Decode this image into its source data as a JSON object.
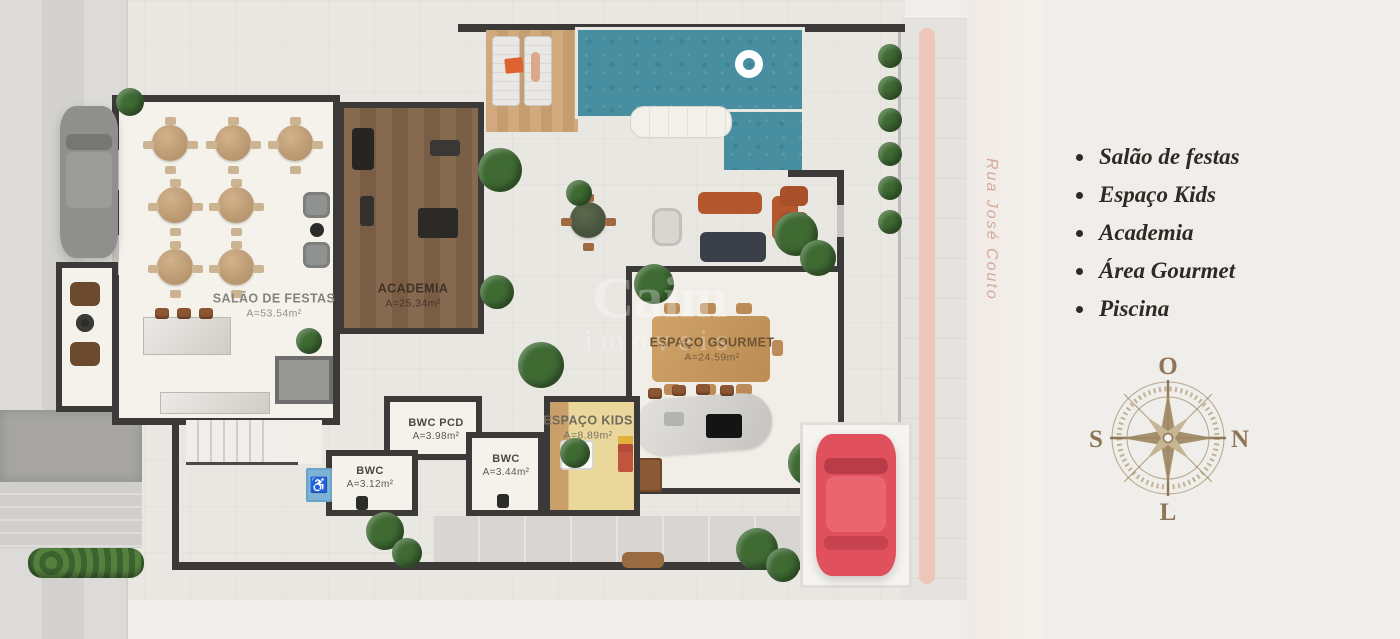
{
  "rooms": {
    "salao": {
      "name": "SALÃO DE FESTAS",
      "area": "A=53.54m²"
    },
    "academia": {
      "name": "ACADEMIA",
      "area": "A=25.34m²"
    },
    "gourmet": {
      "name": "ESPAÇO GOURMET",
      "area": "A=24.59m²"
    },
    "kids": {
      "name": "ESPAÇO KIDS",
      "area": "A=8.89m²"
    },
    "bwc_pcd": {
      "name": "BWC PCD",
      "area": "A=3.98m²"
    },
    "bwc_small": {
      "name": "BWC",
      "area": "A=3.12m²"
    },
    "bwc_mid": {
      "name": "BWC",
      "area": "A=3.44m²"
    }
  },
  "street": {
    "name": "Rua José Couto"
  },
  "watermark": {
    "line1": "Caim",
    "line2": "imóveis"
  },
  "legend": {
    "items": [
      {
        "label": "Salão de festas"
      },
      {
        "label": "Espaço Kids"
      },
      {
        "label": "Academia"
      },
      {
        "label": "Área Gourmet"
      },
      {
        "label": "Piscina"
      }
    ]
  },
  "compass": {
    "top": "O",
    "right": "N",
    "left": "S",
    "bottom": "L"
  },
  "colors": {
    "pool": "#478ea0",
    "wall": "#3b3a38",
    "road_stripe": "#eec3b5",
    "street_text": "#d5a99b",
    "legend_text": "#2f2823",
    "compass": "#8d7656",
    "red_car": "#e0515d"
  }
}
